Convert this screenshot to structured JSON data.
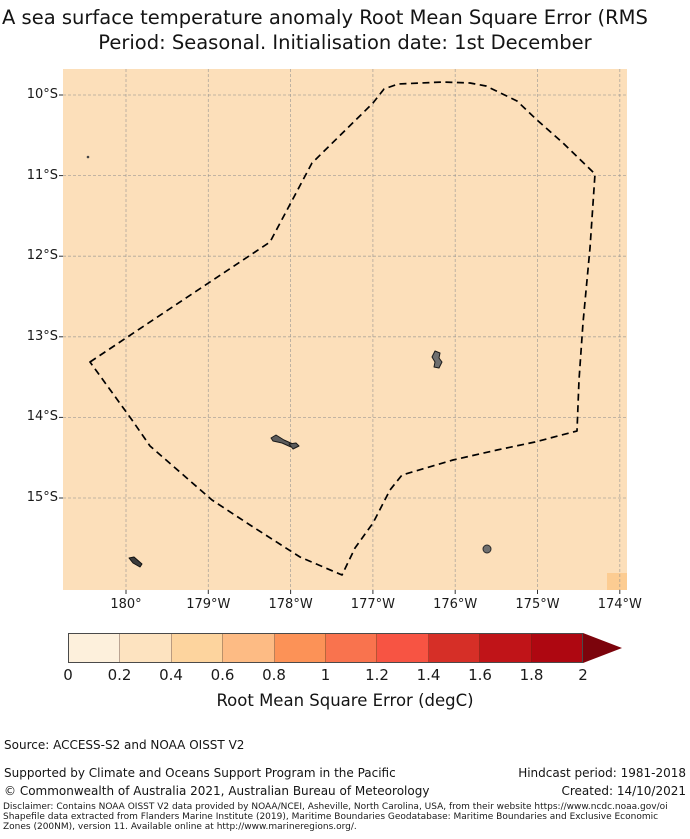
{
  "title": {
    "line1": "A sea surface temperature anomaly Root Mean Square Error (RMS",
    "line2": "Period: Seasonal. Initialisation date: 1st December"
  },
  "map": {
    "ocean_color": "#fcdfba",
    "high_value_cell_color": "#fccc92",
    "gridline_color": "#8f8f8f",
    "x_tick_labels": [
      "180°",
      "179°W",
      "178°W",
      "177°W",
      "176°W",
      "175°W",
      "174°W"
    ],
    "y_tick_labels": [
      "10°S",
      "11°S",
      "12°S",
      "13°S",
      "14°S",
      "15°S"
    ],
    "boundary_color": "#000000",
    "boundary_points": "90,362 270,242 312,163 373,103 384,89 398,84 443,82 470,83 486,86 517,101 537,120 563,143 595,174 590,248 583,323 579,380 577,431 535,442 497,450 453,460 402,475 390,490 373,523 355,548 342,575 300,557 250,525 212,500 150,446 132,420",
    "islands": [
      {
        "kind": "polygon",
        "points": "435,351 440,353 439,358 442,362 439,368 434,367 435,362 432,357",
        "fill": "#6f6f6f",
        "stroke": "#1a1a1a"
      },
      {
        "kind": "polygon",
        "points": "271,438 276,435 284,440 293,444 291,447 282,443 273,441",
        "fill": "#5c5c5c",
        "stroke": "#1a1a1a"
      },
      {
        "kind": "polygon",
        "points": "289,444 296,443 299,446 293,449",
        "fill": "#5c5c5c",
        "stroke": "#1a1a1a"
      },
      {
        "kind": "circle",
        "cx": 487,
        "cy": 549,
        "r": 4,
        "fill": "#6f6f6f",
        "stroke": "#2a2a2a"
      },
      {
        "kind": "polygon",
        "points": "129,558 134,557 142,564 140,567 133,563",
        "fill": "#3c3c3c",
        "stroke": "#111111"
      },
      {
        "kind": "circle",
        "cx": 88,
        "cy": 157,
        "r": 1.3,
        "fill": "#444444",
        "stroke": "none"
      }
    ]
  },
  "colorbar": {
    "label": "Root Mean Square Error (degC)",
    "tick_labels": [
      "0",
      "0.2",
      "0.4",
      "0.6",
      "0.8",
      "1",
      "1.2",
      "1.4",
      "1.6",
      "1.8",
      "2"
    ],
    "segment_colors": [
      "#fdf0dc",
      "#fde3c0",
      "#fdd49e",
      "#fdbb84",
      "#fc9257",
      "#f9734e",
      "#f75443",
      "#d62f27",
      "#c01418",
      "#ae0711"
    ],
    "arrow_color": "#7c040c"
  },
  "annotations": {
    "source": "Source: ACCESS-S2 and NOAA OISST V2",
    "supported_by": "Supported by Climate and Oceans Support Program in the Pacific",
    "copyright": "© Commonwealth of Australia 2021, Australian Bureau of Meteorology",
    "hindcast_period": "Hindcast period: 1981-2018",
    "created": "Created: 14/10/2021",
    "disclaimer_line1": "Disclaimer: Contains NOAA OISST V2 data provided by NOAA/NCEI, Asheville, North Carolina, USA, from their website https://www.ncdc.noaa.gov/oi",
    "disclaimer_line2": "Shapefile data extracted from Flanders Marine Institute (2019), Maritime Boundaries Geodatabase: Maritime Boundaries and Exclusive Economic",
    "disclaimer_line3": "Zones (200NM), version 11. Available online at http://www.marineregions.org/."
  },
  "chart_data": {
    "type": "heatmap",
    "title": "A sea surface temperature anomaly Root Mean Square Error (RMS",
    "subtitle": "Period: Seasonal. Initialisation date: 1st December",
    "x_ticks": [
      "180°",
      "179°W",
      "178°W",
      "177°W",
      "176°W",
      "175°W",
      "174°W"
    ],
    "y_ticks": [
      "10°S",
      "11°S",
      "12°S",
      "13°S",
      "14°S",
      "15°S"
    ],
    "colorbar_label": "Root Mean Square Error (degC)",
    "colorbar_range": [
      0,
      2
    ],
    "colorbar_extend": "max",
    "field_summary": "Near-uniform RMSE of approximately 0.2-0.4 degC across the mapped EEZ region; one slightly higher cell (~0.5 degC) at the bottom-right corner near 174°W",
    "overlay": "Dashed EEZ boundary polygon with small grey islands (Wallis, Futuna/Alofi area and two outlying islets)"
  }
}
